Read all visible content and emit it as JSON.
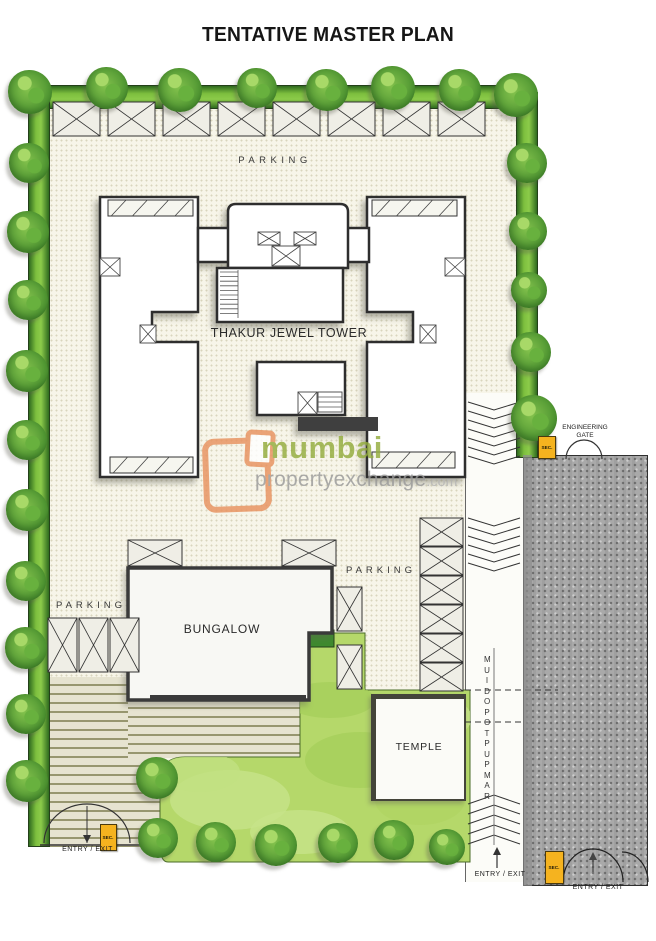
{
  "title": "TENTATIVE MASTER PLAN",
  "plan": {
    "tower_label": "THAKUR JEWEL TOWER",
    "bungalow_label": "BUNGALOW",
    "temple_label": "TEMPLE",
    "ramp_label": "RAMP UP TO PODIUM",
    "parking_labels": {
      "top": "PARKING",
      "left": "PARKING",
      "middle": "PARKING"
    },
    "engineering_gate_label": "ENGINEERING GATE",
    "entry_exit_labels": {
      "left": "ENTRY / EXIT",
      "ramp": "ENTRY / EXIT",
      "road": "ENTRY / EXIT"
    },
    "security_cabin_label": "SEC."
  },
  "watermark": {
    "brand_top": "mumbai",
    "brand_bottom": "propertyexchange",
    "brand_tld": ".com"
  },
  "colors": {
    "wall_dark": "#2e2e2e",
    "site_cream": "#f7f5e9",
    "hedge_green": "#6fb33c",
    "lawn_green": "#b5d86a",
    "paving_tan": "#e6e3d0",
    "paving_stripe": "#97966f",
    "road_gray": "#a9a9a9",
    "security_yellow": "#f5b31f",
    "watermark_orange": "#e8925f",
    "watermark_green": "#94ad3e",
    "watermark_gray": "#9a9a9a"
  }
}
